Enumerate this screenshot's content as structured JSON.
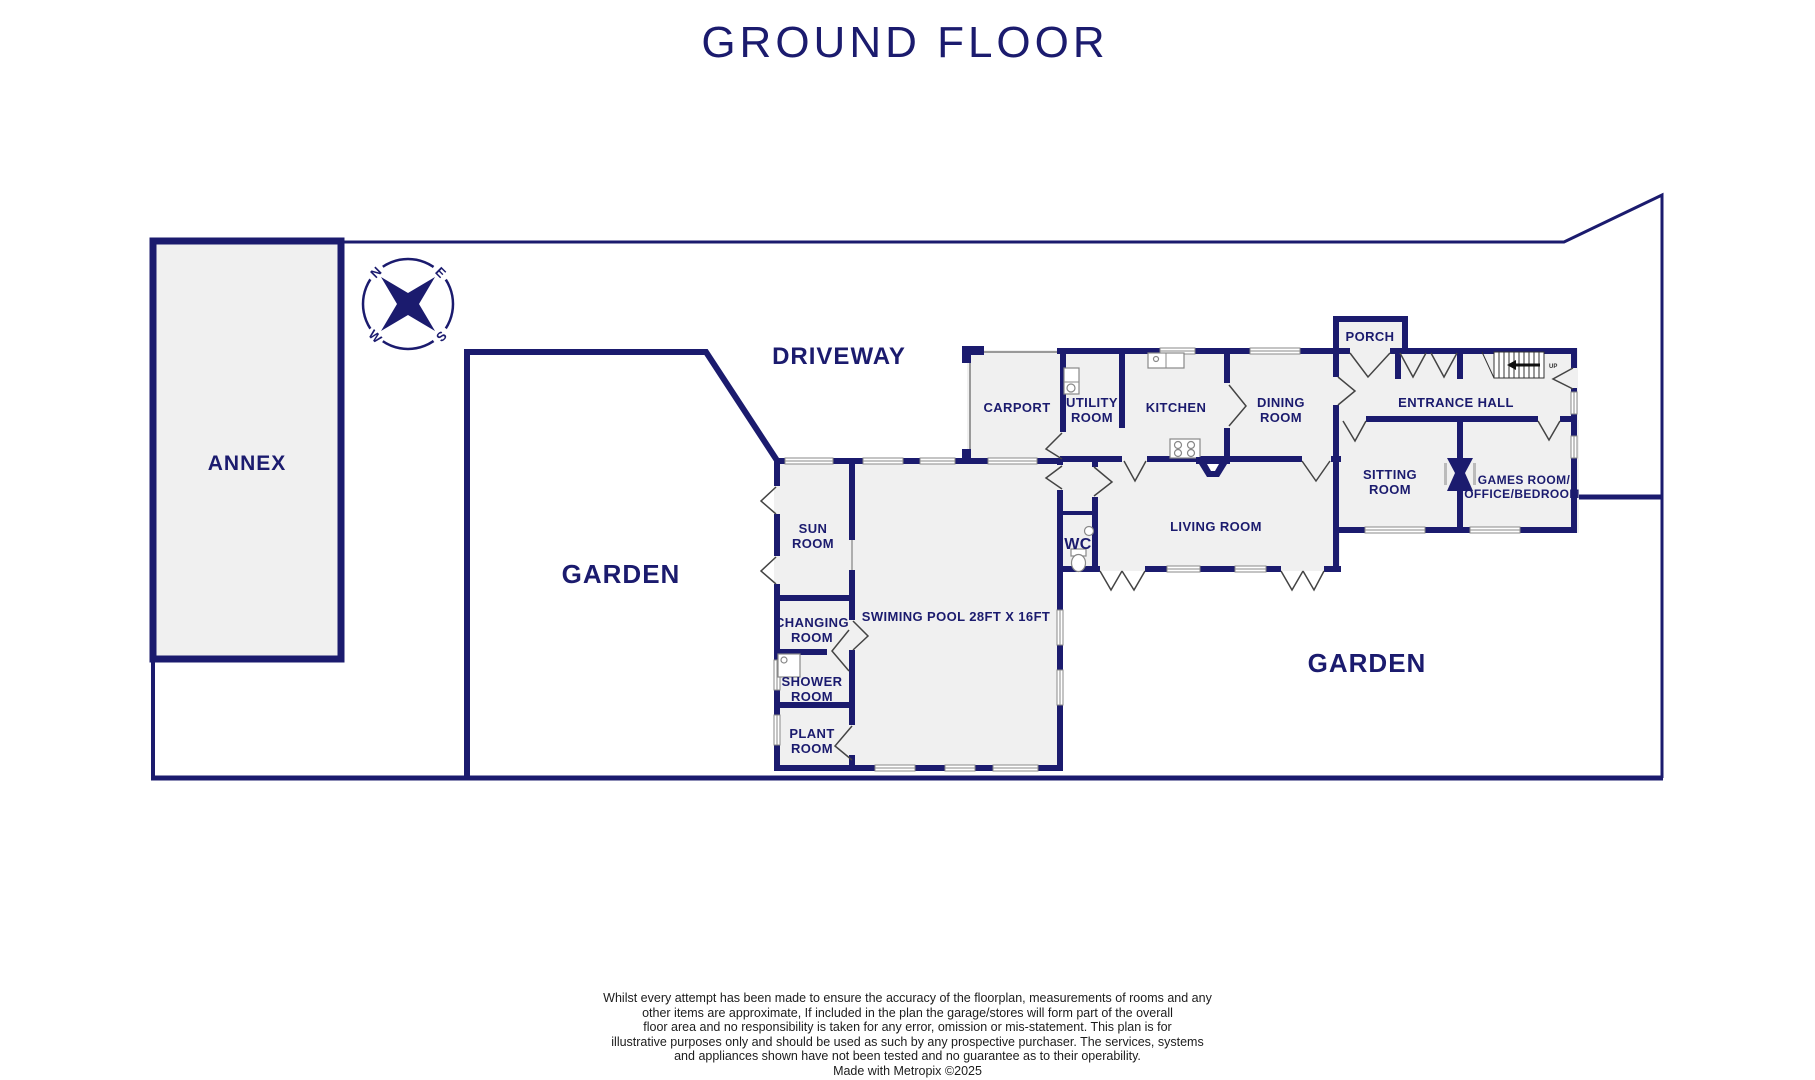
{
  "title": "GROUND FLOOR",
  "compass": {
    "n": "N",
    "e": "E",
    "s": "S",
    "w": "W"
  },
  "areas": {
    "annex": "ANNEX",
    "driveway": "DRIVEWAY",
    "garden_left": "GARDEN",
    "garden_right": "GARDEN"
  },
  "rooms": {
    "carport": [
      "CARPORT"
    ],
    "utility": [
      "UTILITY",
      "ROOM"
    ],
    "kitchen": [
      "KITCHEN"
    ],
    "dining": [
      "DINING",
      "ROOM"
    ],
    "porch": [
      "PORCH"
    ],
    "entrance_hall": [
      "ENTRANCE HALL"
    ],
    "sitting": [
      "SITTING",
      "ROOM"
    ],
    "games": [
      "GAMES ROOM/",
      "OFFICE/BEDROOM"
    ],
    "living": [
      "LIVING ROOM"
    ],
    "wc": [
      "WC"
    ],
    "sun": [
      "SUN",
      "ROOM"
    ],
    "pool": [
      "SWIMING POOL 28FT X 16FT"
    ],
    "changing": [
      "CHANGING",
      "ROOM"
    ],
    "shower": [
      "SHOWER",
      "ROOM"
    ],
    "plant": [
      "PLANT",
      "ROOM"
    ]
  },
  "stairs": {
    "up_label": "UP"
  },
  "disclaimer": [
    "Whilst every attempt has been made to ensure the accuracy of the floorplan, measurements of rooms and any",
    "other items are approximate, If included in the plan the garage/stores will form part of the overall",
    "floor area and no responsibility is taken for any error, omission or mis-statement. This plan is for",
    "illustrative purposes only and should be used as such by any prospective purchaser. The services, systems",
    "and appliances shown have not been tested and no guarantee as to their operability.",
    "Made with Metropix ©2025"
  ],
  "colors": {
    "wall": "#1b1b6e",
    "room_fill": "#f0f0f0",
    "window": "#8a8a8a",
    "door_line": "#444444",
    "label_text": "#1b1b6e",
    "disclaimer_text": "#1c1c1c"
  }
}
